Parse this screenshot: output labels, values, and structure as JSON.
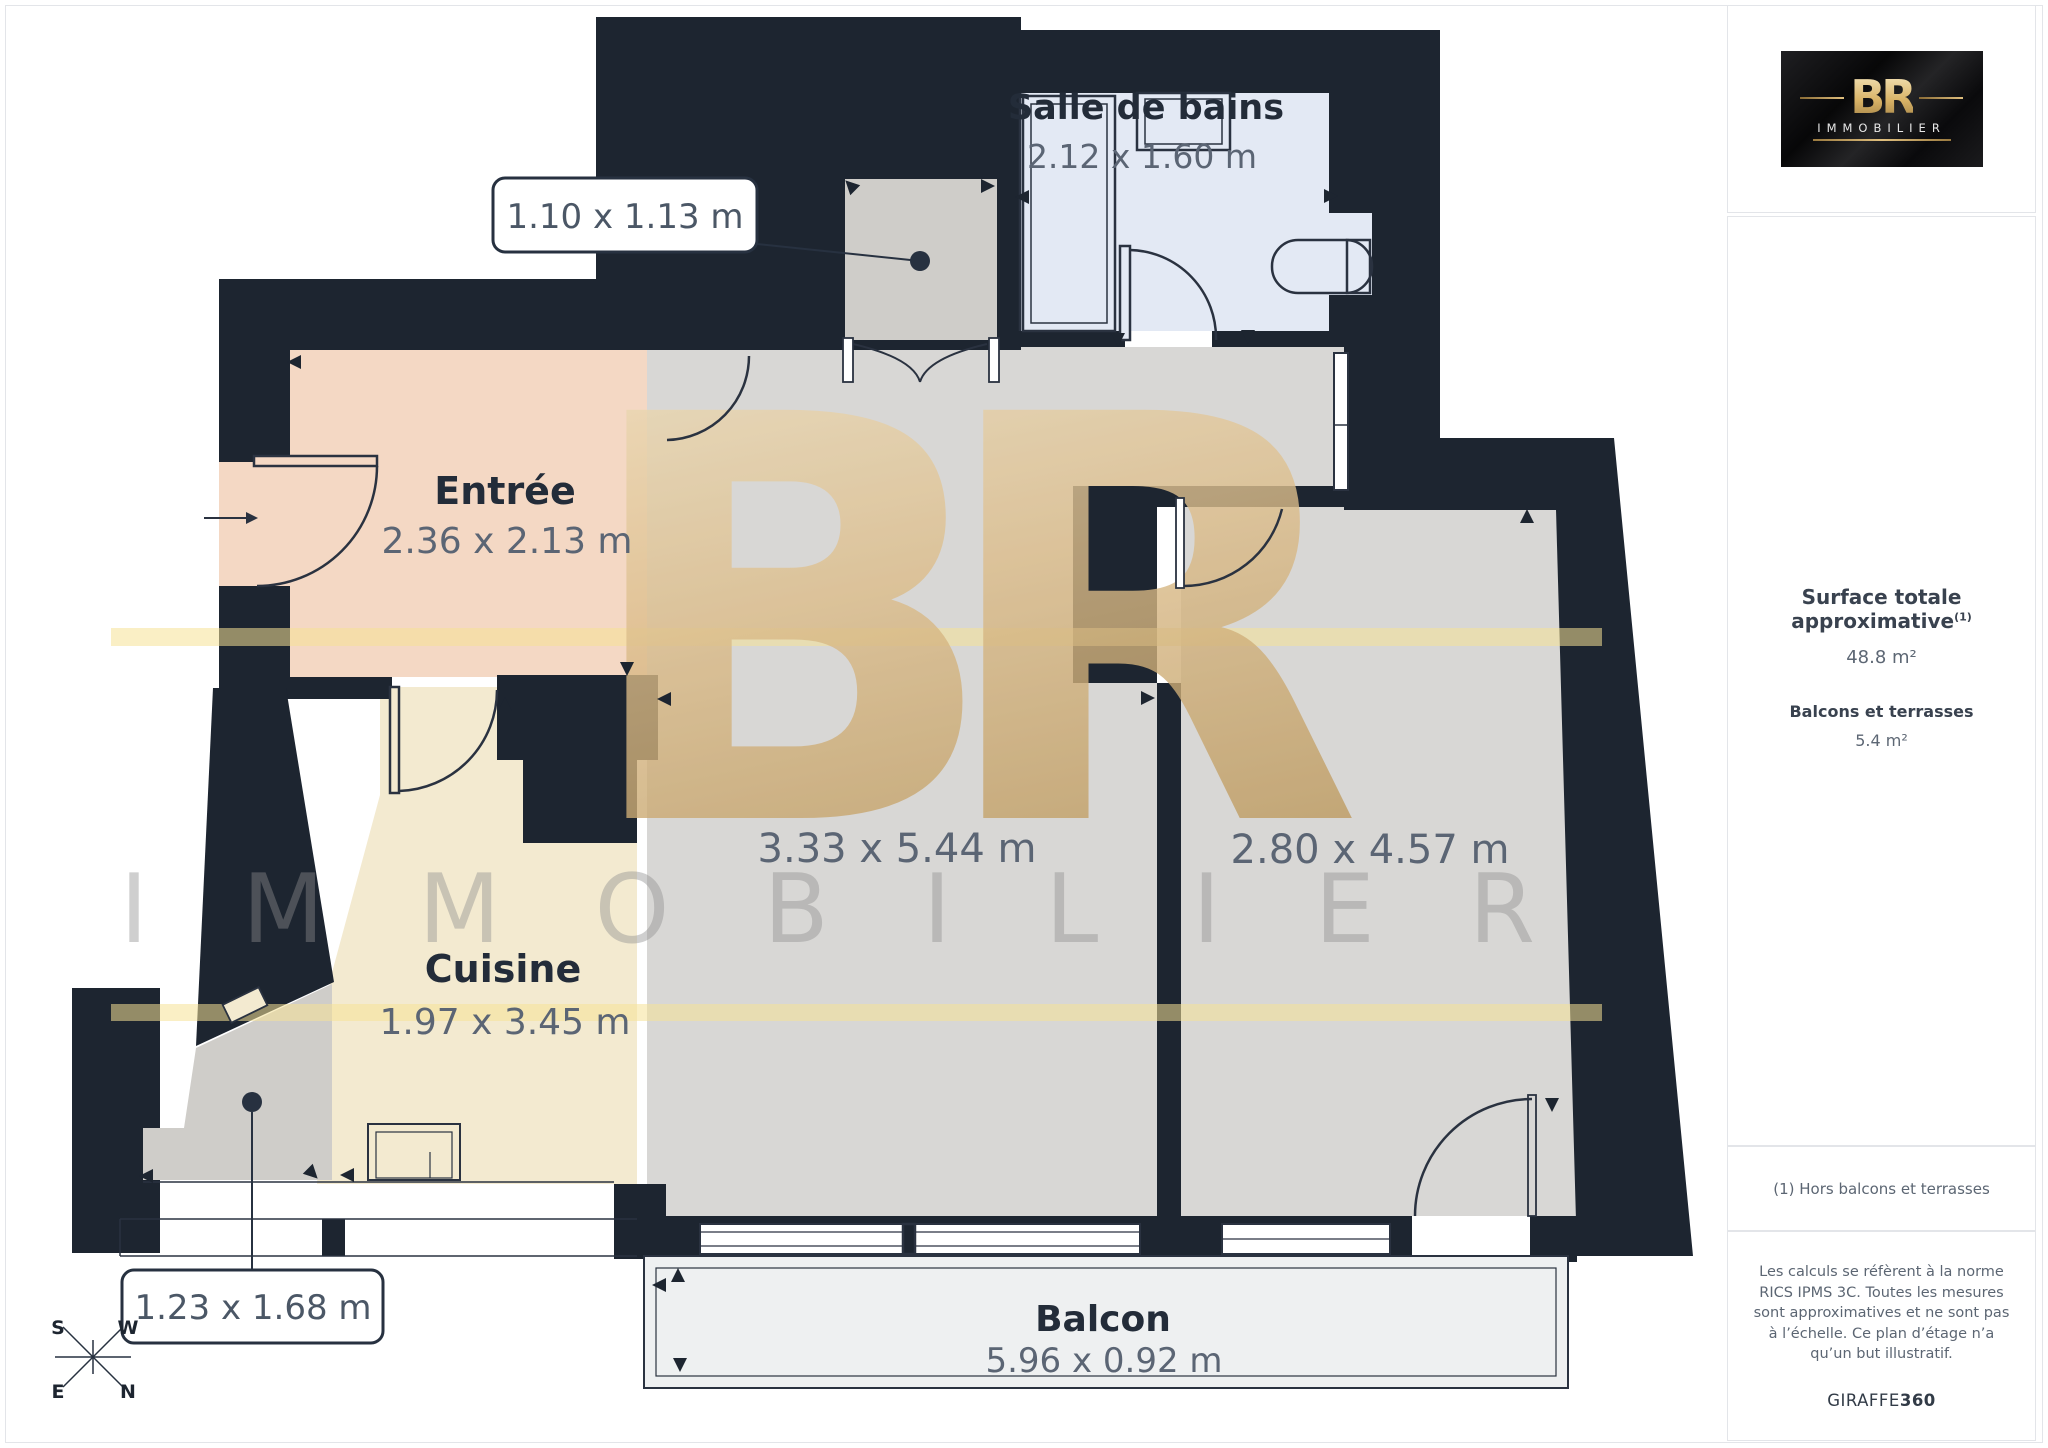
{
  "floorplan": {
    "rooms": [
      {
        "name": "Entrée",
        "dims": "2.36 x 2.13 m"
      },
      {
        "name": "Cuisine",
        "dims": "1.97 x 3.45 m"
      },
      {
        "name": "Salle de bains",
        "dims": "2.12 x 1.60 m"
      },
      {
        "name": "",
        "dims": "3.33 x 5.44 m"
      },
      {
        "name": "",
        "dims": "2.80 x 4.57 m"
      },
      {
        "name": "Balcon",
        "dims": "5.96 x 0.92 m"
      }
    ],
    "callouts": [
      {
        "label": "1.10 x 1.13 m"
      },
      {
        "label": "1.23 x 1.68 m"
      }
    ],
    "compass": {
      "s": "S",
      "w": "W",
      "e": "E",
      "n": "N"
    },
    "watermark": {
      "monogram": "BR",
      "word": "IMMOBILIER"
    }
  },
  "sidebar": {
    "logo": {
      "monogram": "BR",
      "word": "IMMOBILIER"
    },
    "surface_title": "Surface totale approximative",
    "surface_sup": "(1)",
    "surface_value": "48.8 m²",
    "balconies_title": "Balcons et terrasses",
    "balconies_value": "5.4 m²",
    "footnote": "(1) Hors balcons et terrasses",
    "disclaimer": "Les calculs se réfèrent à la norme RICS IPMS 3C. Toutes les mesures sont approximatives et ne sont pas à l’échelle. Ce plan d’étage n’a qu’un but illustratif.",
    "brand": "GIRAFFE",
    "brand_bold": "360"
  },
  "colors": {
    "wall": "#1d2530",
    "entree": "#f4d8c4",
    "kitchen": "#f3ead0",
    "bathroom": "#e3e9f4",
    "floor_gray": "#d8d7d5",
    "balcony": "#eef0f1",
    "gold": "#d9b97f",
    "band_yellow": "#f6e196",
    "label_dark": "#232c39",
    "label_dim": "#5b6574"
  }
}
